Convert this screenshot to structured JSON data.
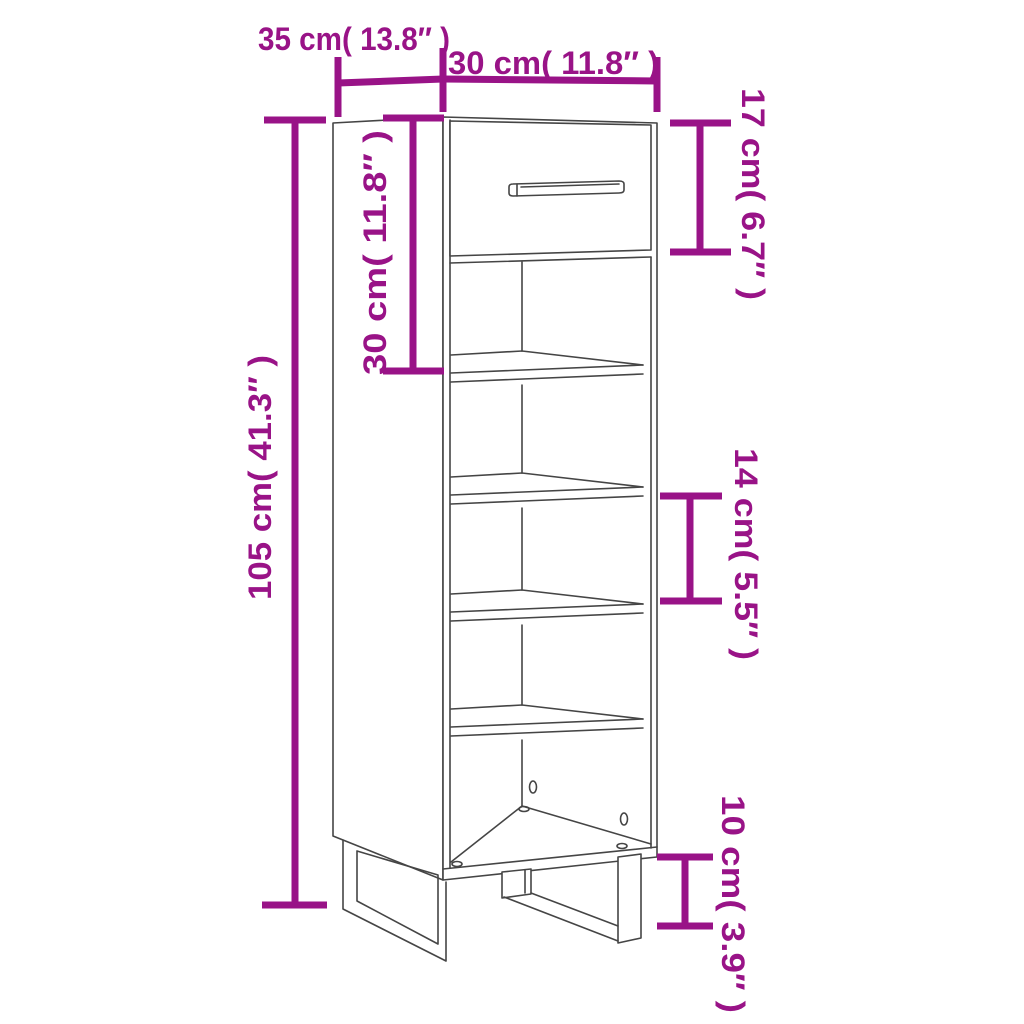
{
  "page": {
    "description": "Shoe cabinet line drawing with dimension annotations",
    "background": "#ffffff"
  },
  "style": {
    "accent": "#991387",
    "line": "#454545",
    "bg": "#ffffff"
  },
  "dimensions": [
    {
      "id": "top-depth",
      "text": "35 cm( 13.8″ )"
    },
    {
      "id": "top-width",
      "text": "30 cm( 11.8″ )"
    },
    {
      "id": "drawer-front-height",
      "text": "17 cm( 6.7″ )"
    },
    {
      "id": "drawer-section-height",
      "text": "30 cm( 11.8″ )"
    },
    {
      "id": "total-height",
      "text": "105 cm( 41.3″ )"
    },
    {
      "id": "shelf-spacing",
      "text": "14 cm( 5.5″ )"
    },
    {
      "id": "leg-height",
      "text": "10 cm( 3.9″ )"
    }
  ]
}
